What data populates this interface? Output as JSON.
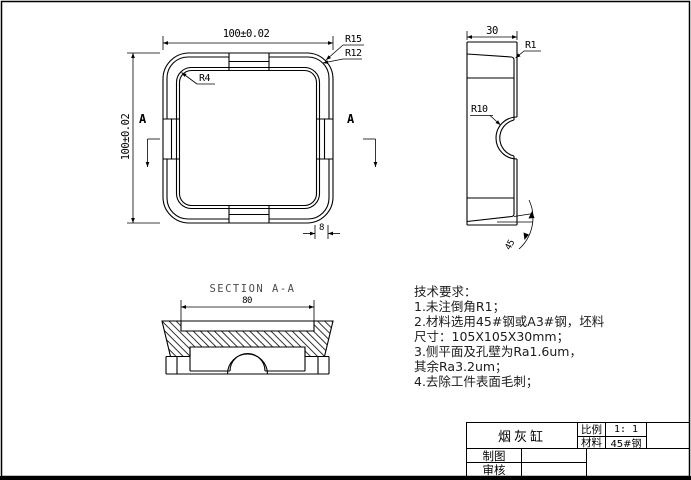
{
  "sheet": {
    "background": "#ffffff",
    "line_color": "#000000"
  },
  "top_view": {
    "dim_width": "100±0.02",
    "dim_height": "100±0.02",
    "radius_outer": "R15",
    "radius_mid": "R12",
    "radius_inner": "R4",
    "section_mark_left": "A",
    "section_mark_right": "A",
    "dim_rim_width": "8"
  },
  "side_view": {
    "dim_depth": "30",
    "radius_top": "R1",
    "radius_notch": "R10",
    "angle_chamfer": "45"
  },
  "section_view": {
    "title": "SECTION A-A",
    "dim_inner_width": "80"
  },
  "tech_requirements": {
    "lines": [
      "技术要求：",
      "1.未注倒角R1；",
      "2.材料选用45#钢或A3#钢，坯料",
      "尺寸：105X105X30mm；",
      "3.侧平面及孔壁为Ra1.6um，",
      "其余Ra3.2um；",
      "4.去除工件表面毛刺；"
    ]
  },
  "title_block": {
    "part_name": "烟灰缸",
    "scale_label": "比例",
    "scale_value": "1: 1",
    "material_label": "材料",
    "material_value": "45#钢",
    "drawn_by_label": "制图",
    "checked_by_label": "审核"
  }
}
